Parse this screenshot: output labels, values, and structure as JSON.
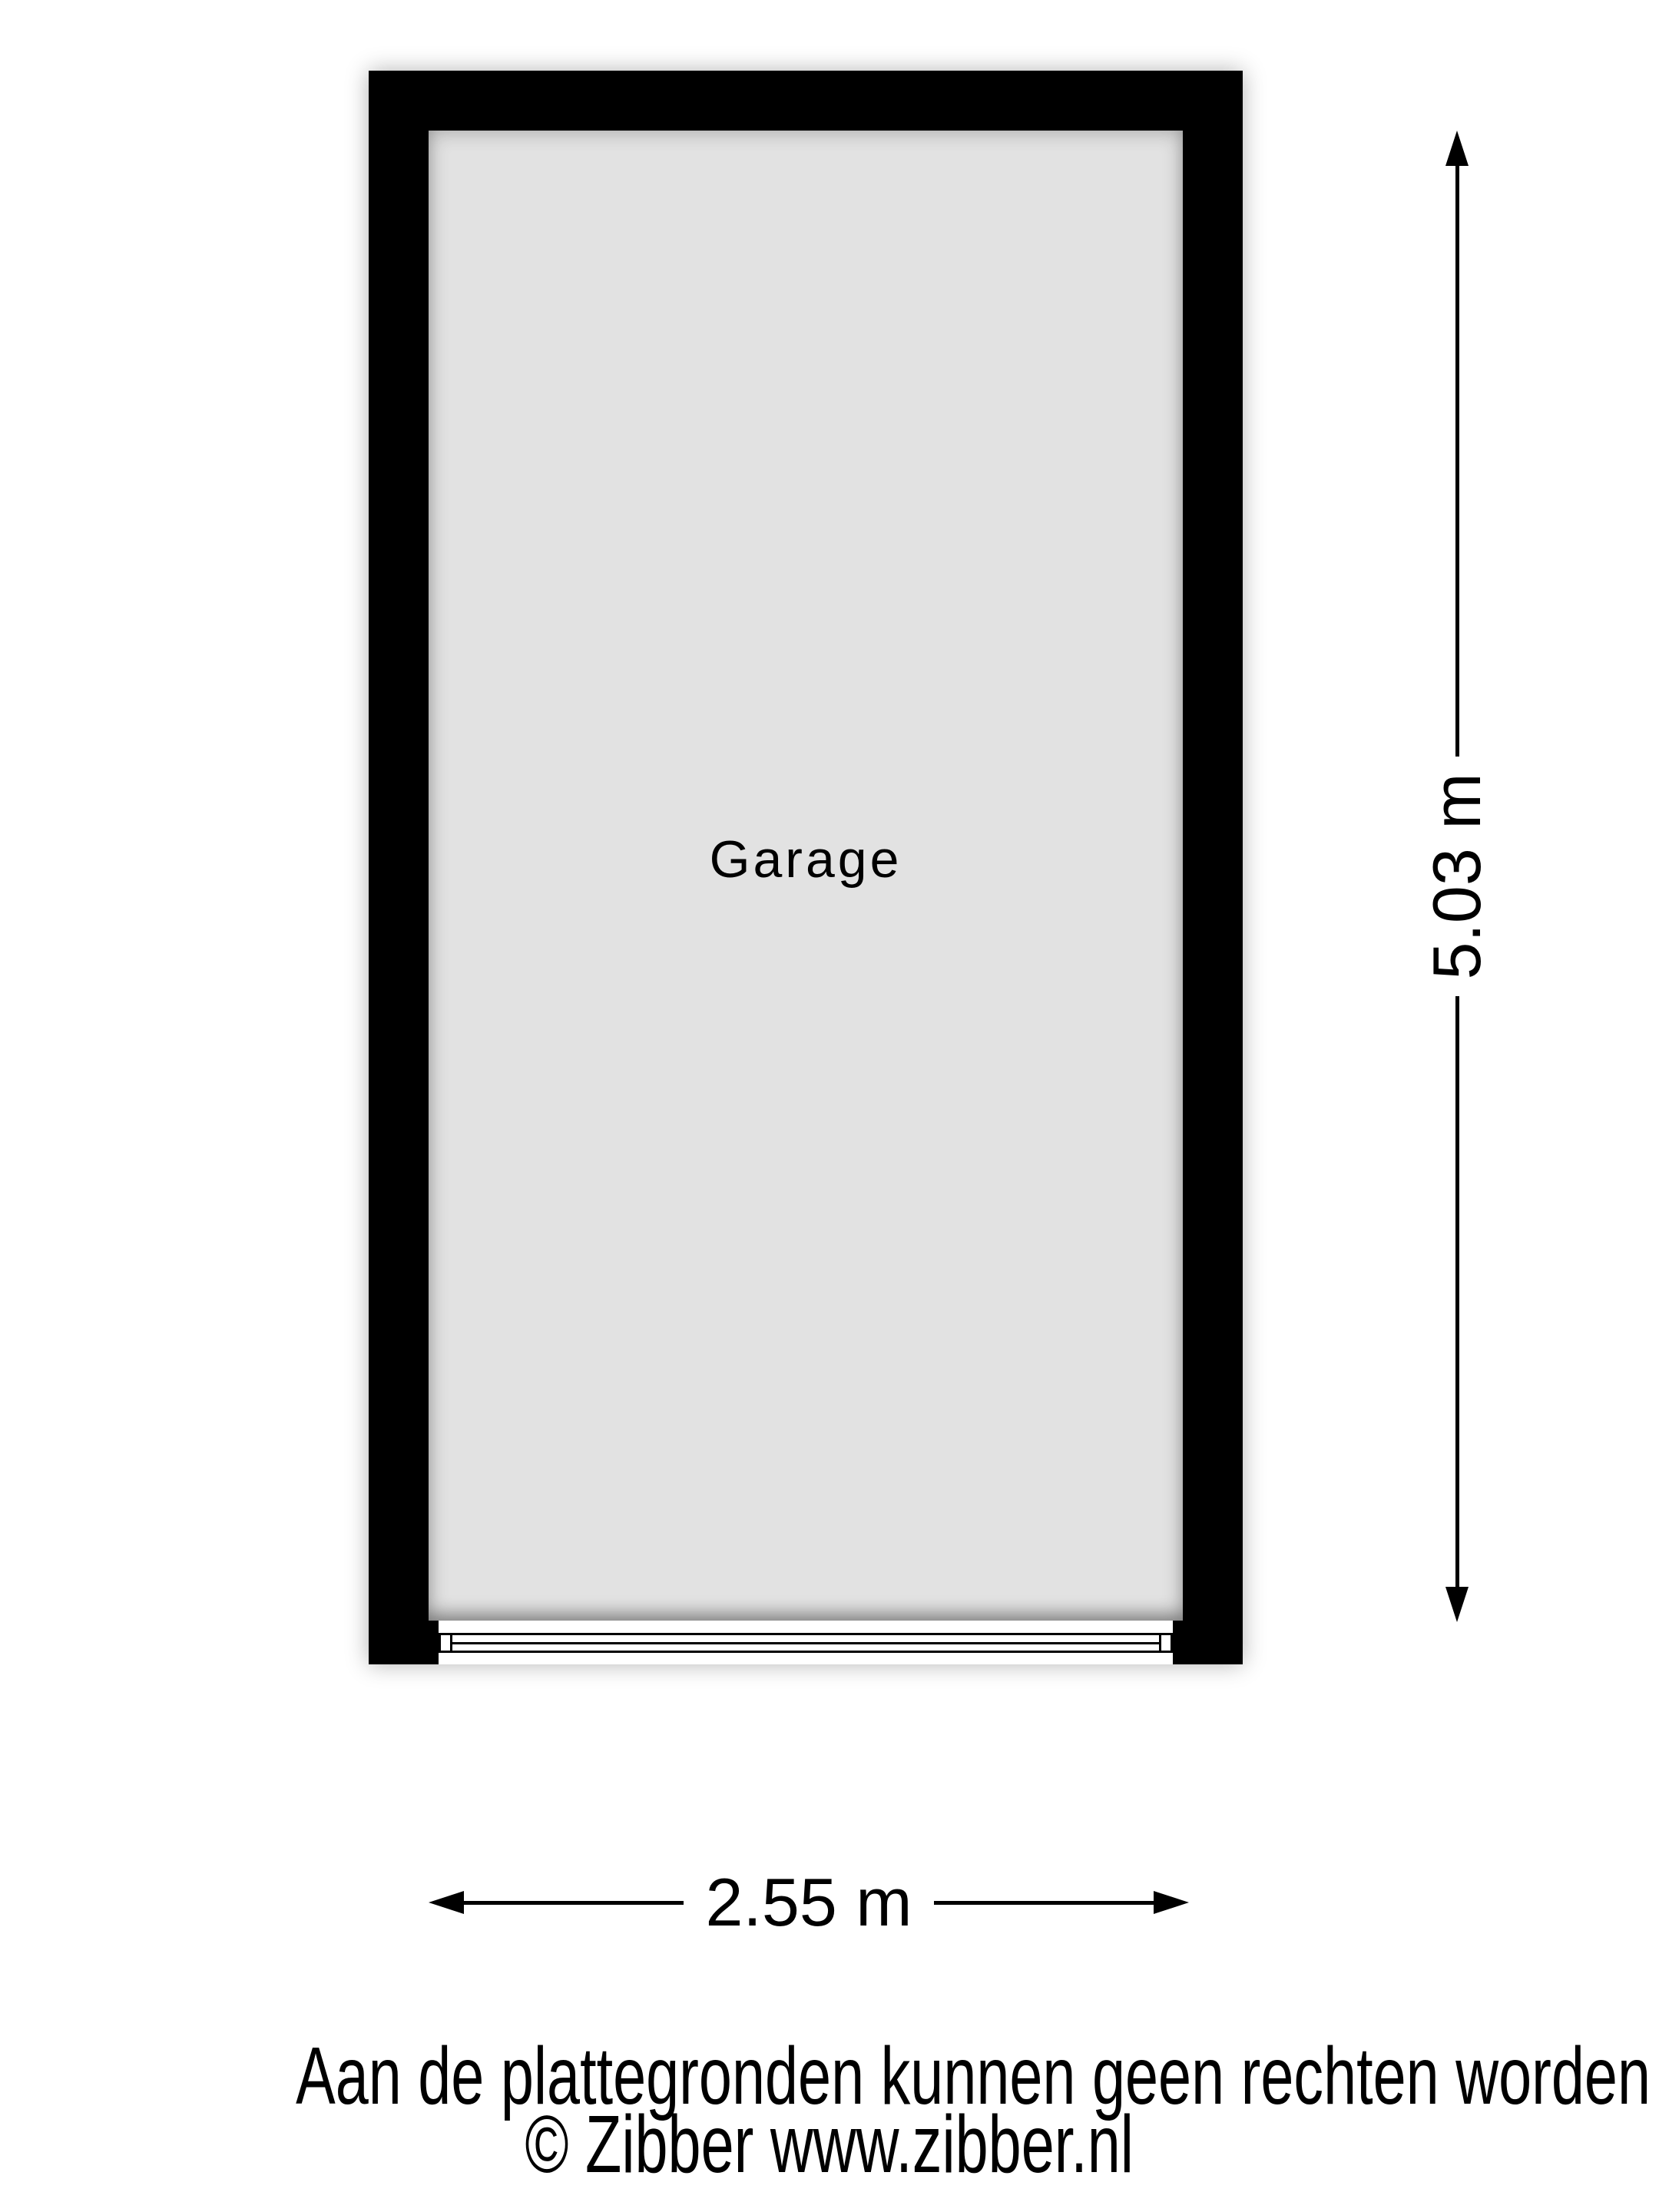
{
  "floorplan": {
    "room_label": "Garage",
    "width_label": "2.55 m",
    "height_label": "5.03 m"
  },
  "footer": {
    "disclaimer": "Aan de plattegronden kunnen geen rechten worden ontleend",
    "copyright": "© Zibber www.zibber.nl"
  },
  "colors": {
    "wall": "#000000",
    "floor": "#e2e2e2",
    "background": "#ffffff",
    "text": "#000000"
  }
}
